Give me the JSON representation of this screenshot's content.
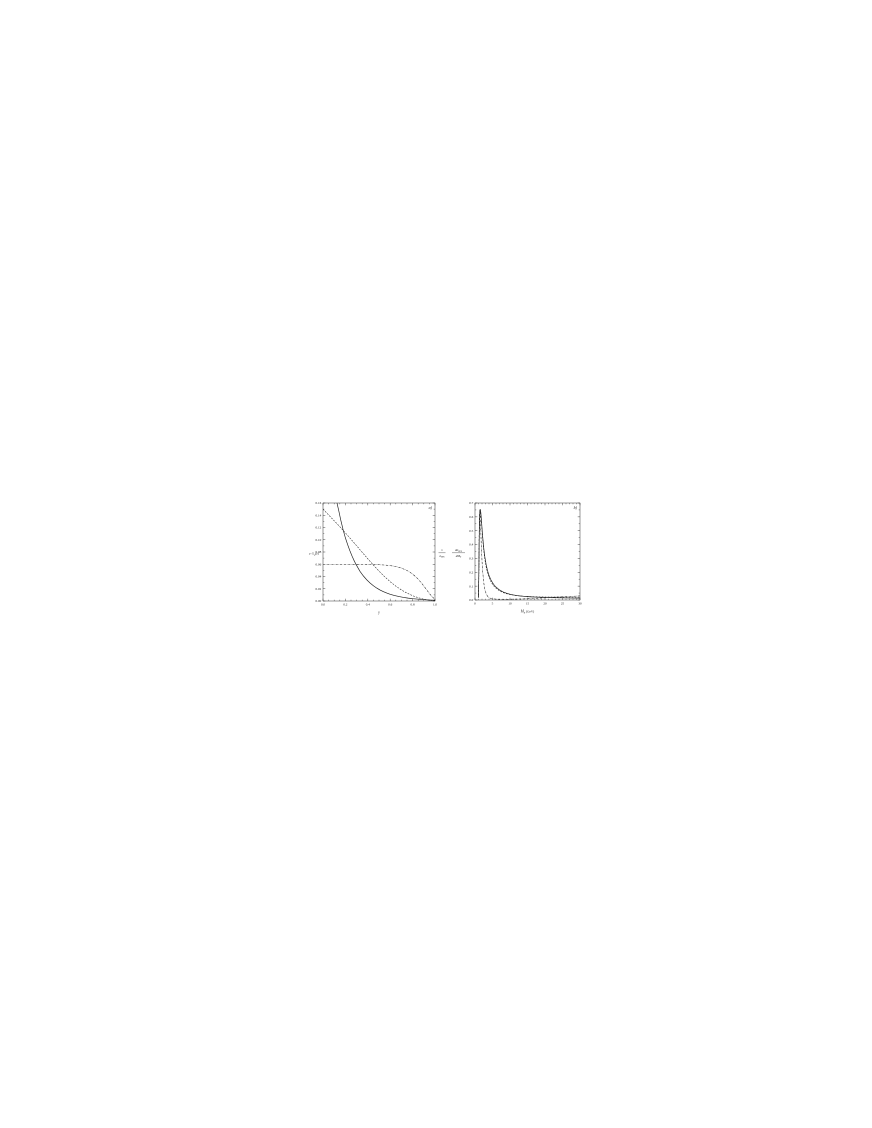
{
  "page": {
    "background": "#ffffff"
  },
  "colors": {
    "ink": "#1c1c1c"
  },
  "chart_data": [
    {
      "id": "a",
      "type": "line",
      "panel_label": "a)",
      "xlabel": {
        "main": "y",
        "sub": "",
        "tail": ""
      },
      "ylabel": {
        "kind": "simple",
        "main": "y G",
        "sub": "p",
        "tail": "(y)"
      },
      "xlim": [
        0,
        1
      ],
      "ylim": [
        0,
        0.16
      ],
      "x_major": [
        0,
        0.2,
        0.4,
        0.6,
        0.8,
        1
      ],
      "x_tick_labels": [
        "0.0",
        "0.2",
        "0.4",
        "0.6",
        "0.8",
        "1.0"
      ],
      "x_minor_step": 0.05,
      "y_major": [
        0,
        0.02,
        0.04,
        0.06,
        0.08,
        0.1,
        0.12,
        0.14,
        0.16
      ],
      "y_tick_labels": [
        "0.00",
        "0.02",
        "0.04",
        "0.06",
        "0.08",
        "0.10",
        "0.12",
        "0.14",
        "0.16"
      ],
      "y_minor_step": 0.01,
      "grid": false,
      "legend": null,
      "series": [
        {
          "name": "steep-falling-flux",
          "style": "solid",
          "points": [
            [
              0.125,
              0.16
            ],
            [
              0.14,
              0.148
            ],
            [
              0.16,
              0.131
            ],
            [
              0.18,
              0.116
            ],
            [
              0.2,
              0.103
            ],
            [
              0.22,
              0.092
            ],
            [
              0.24,
              0.082
            ],
            [
              0.26,
              0.073
            ],
            [
              0.28,
              0.065
            ],
            [
              0.3,
              0.058
            ],
            [
              0.33,
              0.0485
            ],
            [
              0.36,
              0.041
            ],
            [
              0.39,
              0.0347
            ],
            [
              0.42,
              0.0294
            ],
            [
              0.45,
              0.0249
            ],
            [
              0.48,
              0.0211
            ],
            [
              0.51,
              0.0179
            ],
            [
              0.54,
              0.0152
            ],
            [
              0.57,
              0.0129
            ],
            [
              0.6,
              0.011
            ],
            [
              0.64,
              0.0089
            ],
            [
              0.68,
              0.0072
            ],
            [
              0.72,
              0.0058
            ],
            [
              0.76,
              0.0047
            ],
            [
              0.8,
              0.0038
            ],
            [
              0.84,
              0.0031
            ],
            [
              0.88,
              0.0025
            ],
            [
              0.92,
              0.002
            ],
            [
              0.96,
              0.0016
            ],
            [
              1.0,
              0.0013
            ]
          ]
        },
        {
          "name": "linear-falling-flux",
          "style": "dashed",
          "points": [
            [
              0,
              0.15
            ],
            [
              0.05,
              0.1405
            ],
            [
              0.1,
              0.131
            ],
            [
              0.15,
              0.1213
            ],
            [
              0.2,
              0.1112
            ],
            [
              0.25,
              0.1008
            ],
            [
              0.3,
              0.0902
            ],
            [
              0.35,
              0.0795
            ],
            [
              0.4,
              0.0689
            ],
            [
              0.45,
              0.0586
            ],
            [
              0.5,
              0.0488
            ],
            [
              0.55,
              0.0397
            ],
            [
              0.6,
              0.0315
            ],
            [
              0.65,
              0.0243
            ],
            [
              0.7,
              0.0181
            ],
            [
              0.75,
              0.0129
            ],
            [
              0.8,
              0.0087
            ],
            [
              0.85,
              0.0054
            ],
            [
              0.9,
              0.0029
            ],
            [
              0.95,
              0.0013
            ],
            [
              1.0,
              0.0005
            ]
          ]
        },
        {
          "name": "flat-flux",
          "style": "dashdot",
          "points": [
            [
              0,
              0.06
            ],
            [
              0.1,
              0.06
            ],
            [
              0.2,
              0.06
            ],
            [
              0.3,
              0.0599
            ],
            [
              0.4,
              0.0597
            ],
            [
              0.5,
              0.0592
            ],
            [
              0.55,
              0.0587
            ],
            [
              0.6,
              0.0578
            ],
            [
              0.65,
              0.0563
            ],
            [
              0.7,
              0.0538
            ],
            [
              0.75,
              0.0499
            ],
            [
              0.8,
              0.0441
            ],
            [
              0.85,
              0.0357
            ],
            [
              0.9,
              0.0246
            ],
            [
              0.95,
              0.0122
            ],
            [
              1.0,
              0.0022
            ]
          ]
        }
      ]
    },
    {
      "id": "b",
      "type": "line",
      "panel_label": "b)",
      "xlabel": {
        "main": "M",
        "sub": "X",
        "tail": " (GeV)"
      },
      "ylabel": {
        "kind": "double-fraction",
        "f1num": "1",
        "f1den": "σ",
        "f1densub": "DPE",
        "f2num": "dσ",
        "f2numsub": "DPE",
        "f2den": "dM",
        "f2densub": "X"
      },
      "xlim": [
        0,
        30
      ],
      "ylim": [
        0,
        0.7
      ],
      "x_major": [
        0,
        5,
        10,
        15,
        20,
        25,
        30
      ],
      "x_tick_labels": [
        "0",
        "5",
        "10",
        "15",
        "20",
        "25",
        "30"
      ],
      "x_minor_step": 1,
      "y_major": [
        0,
        0.1,
        0.2,
        0.3,
        0.4,
        0.5,
        0.6,
        0.7
      ],
      "y_tick_labels": [
        "0.0",
        "0.1",
        "0.2",
        "0.3",
        "0.4",
        "0.5",
        "0.6",
        "0.7"
      ],
      "y_minor_step": 0.05,
      "grid": false,
      "legend": null,
      "series": [
        {
          "name": "mass-spectrum-solid",
          "style": "solid",
          "points": [
            [
              1.0,
              0.02
            ],
            [
              1.1,
              0.21
            ],
            [
              1.2,
              0.43
            ],
            [
              1.3,
              0.58
            ],
            [
              1.4,
              0.645
            ],
            [
              1.5,
              0.655
            ],
            [
              1.65,
              0.633
            ],
            [
              1.8,
              0.59
            ],
            [
              2.0,
              0.52
            ],
            [
              2.2,
              0.455
            ],
            [
              2.5,
              0.375
            ],
            [
              2.8,
              0.313
            ],
            [
              3.2,
              0.253
            ],
            [
              3.6,
              0.21
            ],
            [
              4.0,
              0.178
            ],
            [
              4.5,
              0.148
            ],
            [
              5.0,
              0.125
            ],
            [
              5.5,
              0.107
            ],
            [
              6.0,
              0.0935
            ],
            [
              7.0,
              0.0725
            ],
            [
              8.0,
              0.0585
            ],
            [
              9.0,
              0.0488
            ],
            [
              10,
              0.0416
            ],
            [
              11,
              0.0362
            ],
            [
              12,
              0.0321
            ],
            [
              13,
              0.0289
            ],
            [
              14,
              0.0263
            ],
            [
              15,
              0.0243
            ],
            [
              16,
              0.0226
            ],
            [
              17,
              0.0212
            ],
            [
              18,
              0.02
            ],
            [
              19,
              0.019
            ],
            [
              20,
              0.0182
            ],
            [
              22,
              0.0168
            ],
            [
              24,
              0.0157
            ],
            [
              26,
              0.0149
            ],
            [
              28,
              0.0142
            ],
            [
              30,
              0.0136
            ]
          ]
        },
        {
          "name": "mass-spectrum-dashed",
          "style": "dashed",
          "points": [
            [
              1.0,
              0.015
            ],
            [
              1.1,
              0.19
            ],
            [
              1.2,
              0.41
            ],
            [
              1.3,
              0.565
            ],
            [
              1.4,
              0.638
            ],
            [
              1.5,
              0.648
            ],
            [
              1.65,
              0.623
            ],
            [
              1.8,
              0.577
            ],
            [
              2.0,
              0.505
            ],
            [
              2.2,
              0.438
            ],
            [
              2.5,
              0.357
            ],
            [
              2.8,
              0.295
            ],
            [
              3.2,
              0.237
            ],
            [
              3.6,
              0.195
            ],
            [
              4.0,
              0.164
            ],
            [
              4.5,
              0.135
            ],
            [
              5.0,
              0.1135
            ],
            [
              5.5,
              0.0975
            ],
            [
              6.0,
              0.085
            ],
            [
              7.0,
              0.066
            ],
            [
              8.0,
              0.0537
            ],
            [
              9.0,
              0.0452
            ],
            [
              10,
              0.0391
            ],
            [
              12,
              0.0314
            ],
            [
              14,
              0.0269
            ],
            [
              16,
              0.0243
            ],
            [
              18,
              0.0228
            ],
            [
              20,
              0.0219
            ],
            [
              22,
              0.0214
            ],
            [
              24,
              0.0211
            ],
            [
              26,
              0.021
            ],
            [
              28,
              0.0209
            ],
            [
              30,
              0.0209
            ]
          ]
        },
        {
          "name": "mass-spectrum-dashdot",
          "style": "dashdot",
          "points": [
            [
              1.0,
              0.03
            ],
            [
              1.1,
              0.26
            ],
            [
              1.2,
              0.5
            ],
            [
              1.3,
              0.625
            ],
            [
              1.4,
              0.652
            ],
            [
              1.5,
              0.6
            ],
            [
              1.65,
              0.5
            ],
            [
              1.8,
              0.395
            ],
            [
              2.0,
              0.285
            ],
            [
              2.2,
              0.205
            ],
            [
              2.5,
              0.125
            ],
            [
              2.8,
              0.0785
            ],
            [
              3.2,
              0.0445
            ],
            [
              3.6,
              0.0265
            ],
            [
              4.0,
              0.0172
            ],
            [
              4.5,
              0.0115
            ],
            [
              5.0,
              0.0088
            ],
            [
              6.0,
              0.0063
            ],
            [
              7.0,
              0.0055
            ],
            [
              8.0,
              0.0053
            ],
            [
              9.0,
              0.0054
            ],
            [
              10,
              0.0057
            ],
            [
              12,
              0.0068
            ],
            [
              14,
              0.0085
            ],
            [
              16,
              0.0107
            ],
            [
              18,
              0.0131
            ],
            [
              20,
              0.0158
            ],
            [
              22,
              0.0186
            ],
            [
              24,
              0.0214
            ],
            [
              26,
              0.0242
            ],
            [
              28,
              0.027
            ],
            [
              30,
              0.0298
            ]
          ]
        }
      ]
    }
  ]
}
